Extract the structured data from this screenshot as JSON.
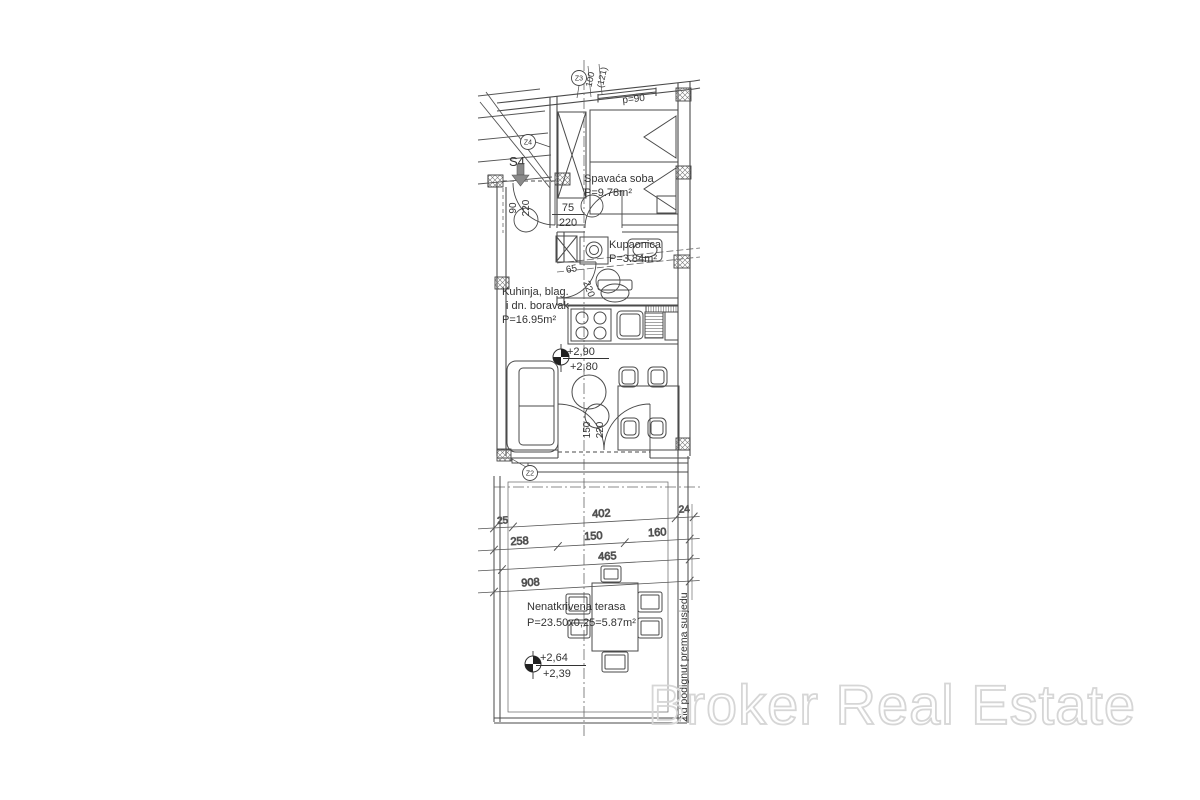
{
  "watermark": {
    "text": "Broker Real Estate"
  },
  "unit": {
    "label": "S4"
  },
  "markers": {
    "z2": "Z2",
    "z3": "Z3",
    "z4": "Z4"
  },
  "rooms": {
    "bedroom": {
      "name": "Spavaća soba",
      "area": "P=9.78m²"
    },
    "bathroom": {
      "name": "Kupaonica",
      "area": "P=3.84m²"
    },
    "living": {
      "name_line1": "Kuhinja, blag.",
      "name_line2": "i dn. boravak",
      "area": "P=16.95m²"
    },
    "terrace": {
      "name": "Nenatkrivena terasa",
      "area": "P=23.50x0,25=5.87m²"
    }
  },
  "levels": {
    "living_top": "+2,90",
    "living_bottom": "+2,80",
    "terrace_top": "+2,64",
    "terrace_bottom": "+2,39"
  },
  "openings": {
    "entrance": {
      "w": "90",
      "h": "220"
    },
    "bedroom_door": {
      "w": "75",
      "h": "220"
    },
    "bathroom_door": {
      "w": "65",
      "h": "220"
    },
    "terrace_door": {
      "w": "150",
      "h": "220"
    },
    "roof_window": {
      "label": "p=90",
      "dim1": "100",
      "dim2": "(121)"
    }
  },
  "dimensions": {
    "row1": [
      "25",
      "402",
      "24"
    ],
    "row2": [
      "258",
      "150",
      "160"
    ],
    "row3": "465",
    "row4": "908"
  },
  "notes": {
    "boundary_wall": "Zid podignut prema susjedu"
  }
}
